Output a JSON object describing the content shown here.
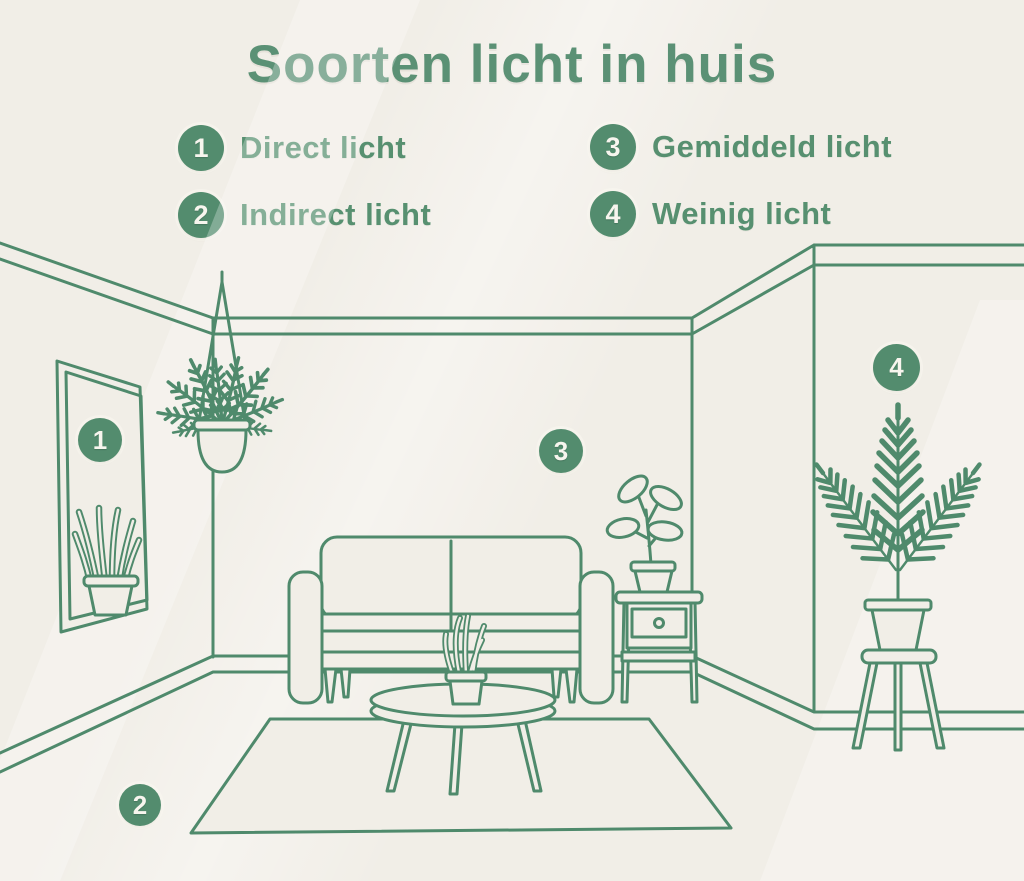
{
  "title": "Soorten licht in huis",
  "legend": {
    "items": [
      {
        "number": "1",
        "label": "Direct licht"
      },
      {
        "number": "2",
        "label": "Indirect licht"
      },
      {
        "number": "3",
        "label": "Gemiddeld licht"
      },
      {
        "number": "4",
        "label": "Weinig licht"
      }
    ]
  },
  "room": {
    "markers": [
      {
        "number": "1",
        "placement": "window"
      },
      {
        "number": "2",
        "placement": "rug"
      },
      {
        "number": "3",
        "placement": "wall-above-side-table"
      },
      {
        "number": "4",
        "placement": "wall-above-palm-plant"
      }
    ]
  },
  "colors": {
    "background": "#f1eee7",
    "line_green": "#4f8a6c",
    "text_green": "#5b9175",
    "badge_green": "#538c6e",
    "badge_text": "#f7f5ee"
  }
}
